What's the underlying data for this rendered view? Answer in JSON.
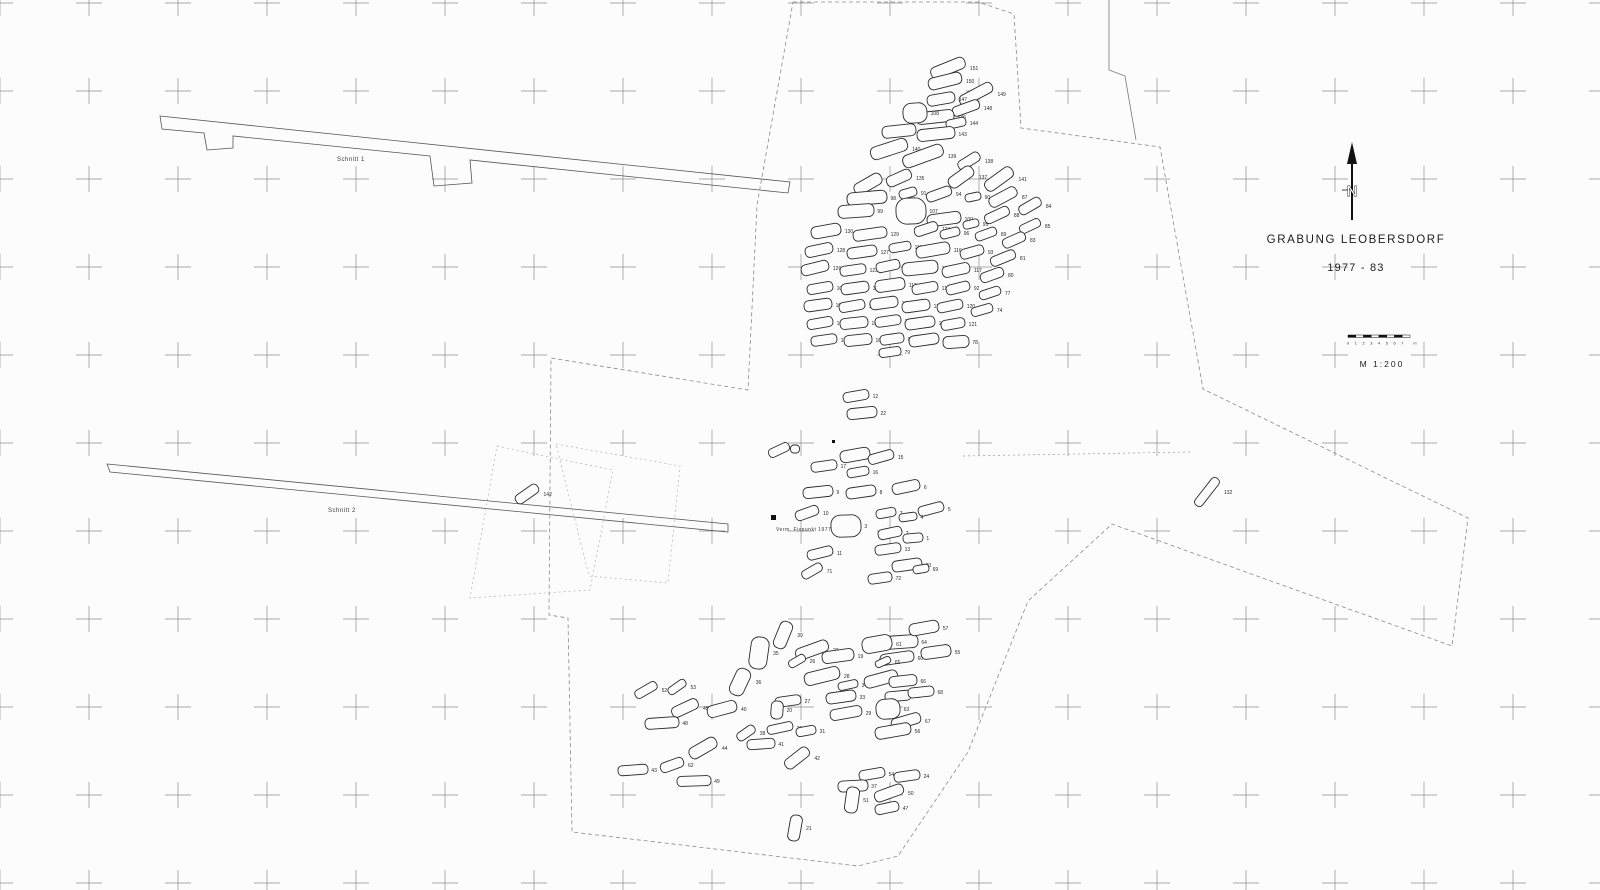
{
  "map": {
    "title": "GRABUNG LEOBERSDORF",
    "years": "1977 - 83",
    "scale_label": "M  1:200",
    "north_letter": "N",
    "scale_ticks": [
      "0",
      "1",
      "2",
      "3",
      "4",
      "5",
      "6",
      "7",
      "m"
    ],
    "ink_color": "#2b2b2b",
    "grid_color": "#6a6a6a",
    "boundary_color": "#8a8a8a"
  },
  "map_labels": [
    {
      "text": "Schnitt 1",
      "x": 337,
      "y": 161,
      "size": 6
    },
    {
      "text": "Schnitt 2",
      "x": 328,
      "y": 512,
      "size": 6
    },
    {
      "text": "Verm. Fixpunkt  1977",
      "x": 776,
      "y": 531,
      "size": 5
    }
  ],
  "grid": {
    "x0": 0,
    "y0": 3,
    "dx": 89,
    "dy": 88,
    "cols": 19,
    "rows": 11,
    "arm": 13
  },
  "points": [
    {
      "x": 771,
      "y": 515,
      "s": 5
    },
    {
      "x": 832,
      "y": 440,
      "s": 3
    }
  ],
  "outlines": [
    {
      "name": "schnitt-1-trench",
      "d": "M160,116 L790,182 L788,193 L470,160 L472,183 L434,186 L430,156 L233,136 L233,148 L207,150 L204,133 L162,129 Z",
      "stroke": "#555",
      "width": 0.8,
      "dash": ""
    },
    {
      "name": "schnitt-2-trench",
      "d": "M107,464 L728,524 L728,532 L110,472 Z",
      "stroke": "#555",
      "width": 0.8,
      "dash": ""
    },
    {
      "name": "main-excavation-boundary",
      "d": "M793,2 L978,2 L1014,14 L1021,128 L1160,147 L1203,389 L1468,518 L1452,646 L1112,524 L1028,601 L968,752 L898,856 L858,866 L572,832 L568,618 L549,615 L551,358 L748,390 L757,205 Z",
      "stroke": "#8a8a8a",
      "width": 0.8,
      "dash": "4 3"
    },
    {
      "name": "north-east-edge",
      "d": "M1109,0 L1109,70 L1125,76 L1136,140",
      "stroke": "#777",
      "width": 0.8,
      "dash": ""
    },
    {
      "name": "survey-line",
      "d": "M963,456 L1190,452",
      "stroke": "#9a9a9a",
      "width": 0.7,
      "dash": "2 3"
    },
    {
      "name": "area-square-a",
      "d": "M497,446 L613,470 L590,590 L470,598 Z",
      "stroke": "#b0b0b0",
      "width": 0.7,
      "dash": "2 3"
    },
    {
      "name": "area-square-b",
      "d": "M556,444 L680,466 L668,583 L589,576 Z",
      "stroke": "#b0b0b0",
      "width": 0.7,
      "dash": "2 3"
    }
  ],
  "graves": [
    [
      948,
      68,
      36,
      12,
      -22,
      "151"
    ],
    [
      945,
      81,
      34,
      12,
      -14,
      "150"
    ],
    [
      976,
      94,
      36,
      11,
      -28,
      "149"
    ],
    [
      941,
      99,
      28,
      11,
      -10,
      "147"
    ],
    [
      966,
      108,
      28,
      10,
      -20,
      "148"
    ],
    [
      935,
      117,
      38,
      12,
      -6,
      "146"
    ],
    [
      915,
      113,
      24,
      20,
      -4,
      "108"
    ],
    [
      956,
      123,
      20,
      9,
      -12,
      "144"
    ],
    [
      899,
      131,
      34,
      12,
      -6,
      "145"
    ],
    [
      936,
      134,
      38,
      12,
      -6,
      "143"
    ],
    [
      889,
      149,
      38,
      13,
      -18,
      "140"
    ],
    [
      923,
      156,
      42,
      13,
      -20,
      "139"
    ],
    [
      969,
      161,
      24,
      10,
      -32,
      "138"
    ],
    [
      961,
      177,
      28,
      12,
      -36,
      "137"
    ],
    [
      999,
      179,
      32,
      12,
      -36,
      "141"
    ],
    [
      868,
      184,
      30,
      12,
      -30,
      "136"
    ],
    [
      899,
      178,
      26,
      11,
      -24,
      "135"
    ],
    [
      867,
      198,
      40,
      13,
      -5,
      "98"
    ],
    [
      908,
      193,
      18,
      9,
      -16,
      "91"
    ],
    [
      939,
      194,
      26,
      10,
      -20,
      "94"
    ],
    [
      973,
      197,
      16,
      8,
      -12,
      "90"
    ],
    [
      1003,
      197,
      30,
      11,
      -28,
      "87"
    ],
    [
      1030,
      206,
      24,
      10,
      -30,
      "84"
    ],
    [
      856,
      211,
      36,
      13,
      -4,
      "99"
    ],
    [
      911,
      211,
      30,
      26,
      -2,
      "107"
    ],
    [
      944,
      219,
      34,
      12,
      -8,
      "100"
    ],
    [
      971,
      224,
      16,
      8,
      -14,
      "95"
    ],
    [
      997,
      215,
      26,
      10,
      -25,
      "88"
    ],
    [
      1030,
      226,
      22,
      9,
      -25,
      "85"
    ],
    [
      826,
      231,
      30,
      12,
      -10,
      "130"
    ],
    [
      870,
      234,
      34,
      11,
      -8,
      "129"
    ],
    [
      926,
      229,
      24,
      10,
      -18,
      "124"
    ],
    [
      950,
      233,
      20,
      9,
      -14,
      "96"
    ],
    [
      986,
      234,
      22,
      9,
      -20,
      "89"
    ],
    [
      1014,
      240,
      24,
      10,
      -24,
      "83"
    ],
    [
      819,
      250,
      28,
      11,
      -12,
      "128"
    ],
    [
      862,
      252,
      30,
      11,
      -8,
      "127"
    ],
    [
      900,
      247,
      22,
      9,
      -10,
      "111"
    ],
    [
      933,
      250,
      34,
      12,
      -10,
      "116"
    ],
    [
      972,
      252,
      24,
      10,
      -16,
      "93"
    ],
    [
      1003,
      258,
      26,
      10,
      -22,
      "81"
    ],
    [
      815,
      268,
      28,
      11,
      -14,
      "126"
    ],
    [
      853,
      270,
      26,
      10,
      -8,
      "123"
    ],
    [
      888,
      266,
      24,
      10,
      -12,
      "114"
    ],
    [
      920,
      268,
      36,
      13,
      -6,
      "118"
    ],
    [
      956,
      270,
      28,
      11,
      -12,
      "117"
    ],
    [
      992,
      275,
      24,
      10,
      -20,
      "80"
    ],
    [
      820,
      288,
      26,
      10,
      -10,
      "105"
    ],
    [
      855,
      288,
      28,
      11,
      -8,
      "113"
    ],
    [
      890,
      285,
      30,
      12,
      -8,
      "112"
    ],
    [
      925,
      288,
      26,
      10,
      -10,
      "110"
    ],
    [
      958,
      288,
      24,
      10,
      -14,
      "92"
    ],
    [
      990,
      293,
      22,
      9,
      -18,
      "77"
    ],
    [
      818,
      305,
      28,
      11,
      -8,
      "101"
    ],
    [
      852,
      306,
      26,
      10,
      -10,
      "109"
    ],
    [
      884,
      303,
      28,
      11,
      -8,
      "131"
    ],
    [
      916,
      306,
      28,
      11,
      -8,
      "134"
    ],
    [
      950,
      306,
      26,
      10,
      -12,
      "120"
    ],
    [
      982,
      310,
      22,
      9,
      -16,
      "74"
    ],
    [
      820,
      323,
      26,
      10,
      -10,
      "103"
    ],
    [
      854,
      323,
      28,
      11,
      -6,
      "106"
    ],
    [
      888,
      321,
      26,
      10,
      -8,
      "133"
    ],
    [
      920,
      323,
      30,
      11,
      -8,
      "122"
    ],
    [
      953,
      324,
      24,
      10,
      -10,
      "121"
    ],
    [
      824,
      340,
      26,
      10,
      -8,
      "104"
    ],
    [
      858,
      340,
      28,
      11,
      -6,
      "102"
    ],
    [
      892,
      339,
      24,
      10,
      -8,
      "97"
    ],
    [
      924,
      340,
      30,
      11,
      -8,
      "125"
    ],
    [
      956,
      342,
      26,
      12,
      -4,
      "78"
    ],
    [
      890,
      352,
      22,
      9,
      -8,
      "79"
    ],
    [
      856,
      396,
      26,
      10,
      -10,
      "12"
    ],
    [
      862,
      413,
      30,
      11,
      -6,
      "22"
    ],
    [
      779,
      450,
      22,
      9,
      -25,
      "18"
    ],
    [
      795,
      449,
      9,
      8,
      0,
      ""
    ],
    [
      855,
      455,
      30,
      12,
      -10,
      "14"
    ],
    [
      881,
      457,
      26,
      10,
      -16,
      "15"
    ],
    [
      824,
      466,
      26,
      10,
      -8,
      "17"
    ],
    [
      858,
      472,
      22,
      9,
      -10,
      "16"
    ],
    [
      906,
      487,
      28,
      11,
      -12,
      "6"
    ],
    [
      818,
      492,
      30,
      11,
      -6,
      "9"
    ],
    [
      861,
      492,
      30,
      11,
      -8,
      "8"
    ],
    [
      931,
      509,
      26,
      10,
      -15,
      "5"
    ],
    [
      807,
      513,
      24,
      10,
      -20,
      "10"
    ],
    [
      886,
      513,
      20,
      9,
      -10,
      "7"
    ],
    [
      908,
      517,
      18,
      8,
      -8,
      "4"
    ],
    [
      846,
      526,
      30,
      22,
      -2,
      "3"
    ],
    [
      890,
      533,
      24,
      10,
      -12,
      "2"
    ],
    [
      913,
      538,
      20,
      9,
      -5,
      "1"
    ],
    [
      888,
      549,
      26,
      10,
      -8,
      "13"
    ],
    [
      820,
      553,
      26,
      10,
      -14,
      "11"
    ],
    [
      907,
      565,
      30,
      11,
      -8,
      "70"
    ],
    [
      812,
      571,
      22,
      9,
      -30,
      "71"
    ],
    [
      880,
      578,
      24,
      10,
      -8,
      "72"
    ],
    [
      921,
      569,
      16,
      8,
      -10,
      "69"
    ],
    [
      759,
      653,
      18,
      32,
      8,
      "35"
    ],
    [
      783,
      635,
      13,
      28,
      22,
      "39"
    ],
    [
      812,
      650,
      34,
      12,
      -20,
      "23"
    ],
    [
      838,
      656,
      32,
      12,
      -8,
      "19"
    ],
    [
      797,
      661,
      18,
      8,
      -30,
      "26"
    ],
    [
      900,
      642,
      36,
      13,
      -4,
      "64"
    ],
    [
      877,
      644,
      30,
      16,
      -10,
      "61"
    ],
    [
      897,
      658,
      34,
      11,
      -8,
      "60"
    ],
    [
      883,
      662,
      16,
      7,
      -25,
      "65"
    ],
    [
      822,
      676,
      36,
      13,
      -14,
      "28"
    ],
    [
      848,
      685,
      20,
      8,
      -12,
      "34"
    ],
    [
      881,
      679,
      34,
      12,
      -15,
      "59"
    ],
    [
      903,
      681,
      28,
      11,
      -6,
      "66"
    ],
    [
      841,
      697,
      30,
      11,
      -8,
      "33"
    ],
    [
      898,
      696,
      26,
      10,
      -5,
      "58"
    ],
    [
      788,
      701,
      26,
      10,
      -8,
      "27"
    ],
    [
      846,
      713,
      32,
      11,
      -10,
      "29"
    ],
    [
      777,
      710,
      12,
      18,
      4,
      "20"
    ],
    [
      888,
      709,
      24,
      20,
      -4,
      "63"
    ],
    [
      906,
      721,
      30,
      11,
      -16,
      "67"
    ],
    [
      780,
      728,
      26,
      9,
      -12,
      "30"
    ],
    [
      806,
      731,
      20,
      9,
      -10,
      "31"
    ],
    [
      893,
      731,
      36,
      12,
      -10,
      "56"
    ],
    [
      746,
      733,
      20,
      9,
      -35,
      "38"
    ],
    [
      761,
      744,
      28,
      10,
      -4,
      "41"
    ],
    [
      907,
      776,
      26,
      10,
      -8,
      "24"
    ],
    [
      797,
      758,
      28,
      11,
      -38,
      "42"
    ],
    [
      872,
      774,
      26,
      10,
      -10,
      "54"
    ],
    [
      853,
      786,
      30,
      11,
      -3,
      "37"
    ],
    [
      889,
      793,
      30,
      11,
      -20,
      "50"
    ],
    [
      887,
      808,
      24,
      10,
      -12,
      "47"
    ],
    [
      740,
      682,
      15,
      28,
      25,
      "36"
    ],
    [
      685,
      708,
      28,
      11,
      -25,
      "45"
    ],
    [
      722,
      709,
      30,
      12,
      -15,
      "40"
    ],
    [
      662,
      723,
      34,
      11,
      -4,
      "48"
    ],
    [
      646,
      690,
      24,
      9,
      -30,
      "52"
    ],
    [
      677,
      687,
      20,
      8,
      -35,
      "53"
    ],
    [
      703,
      748,
      30,
      12,
      -30,
      "44"
    ],
    [
      633,
      770,
      30,
      10,
      -4,
      "43"
    ],
    [
      694,
      781,
      34,
      10,
      -2,
      "49"
    ],
    [
      672,
      765,
      24,
      10,
      -20,
      "62"
    ],
    [
      924,
      628,
      30,
      12,
      -10,
      "57"
    ],
    [
      936,
      652,
      30,
      12,
      -8,
      "55"
    ],
    [
      921,
      692,
      26,
      10,
      -6,
      "68"
    ],
    [
      795,
      828,
      12,
      26,
      10,
      "21"
    ],
    [
      852,
      800,
      13,
      26,
      8,
      "51"
    ],
    [
      1207,
      492,
      34,
      9,
      -52,
      "132"
    ],
    [
      527,
      494,
      26,
      10,
      -35,
      "142"
    ]
  ]
}
